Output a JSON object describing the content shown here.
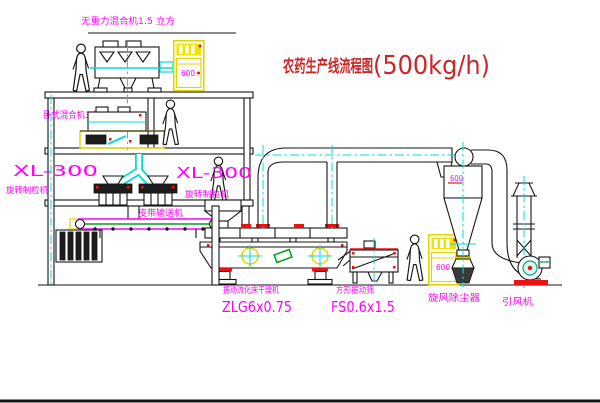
{
  "title": {
    "name": "农药生产线流程图",
    "capacity": "(500kg/h)"
  },
  "labels": {
    "top_mixer": "无重力混合机1.5 立方",
    "second_mixer": "卧式混合机3立方",
    "granulator_left_model": "XL-300",
    "granulator_left_name": "旋转制粒机",
    "granulator_right_model": "XL-300",
    "granulator_right_name": "旋转制粒机",
    "belt_conveyor": "皮带输送机",
    "dryer_name": "振动流化床干燥机",
    "dryer_model": "ZLG6x0.75",
    "sieve_name": "方形振动筛",
    "sieve_model": "FS0.6x1.5",
    "cyclone_name": "旋风除尘器",
    "fan_name": "引风机"
  },
  "markings": {
    "cabinet_top": "600",
    "cabinet_bottom": "600",
    "cyclone_body": "600"
  },
  "colors": {
    "label_magenta": "#ff00ff",
    "title_red": "#cc2626",
    "centerline_cyan": "#00dcdc",
    "cabinet_yellow": "#e3d400",
    "flange_red": "#ee1111",
    "detail_green": "#00a020",
    "line_black": "#151515"
  }
}
